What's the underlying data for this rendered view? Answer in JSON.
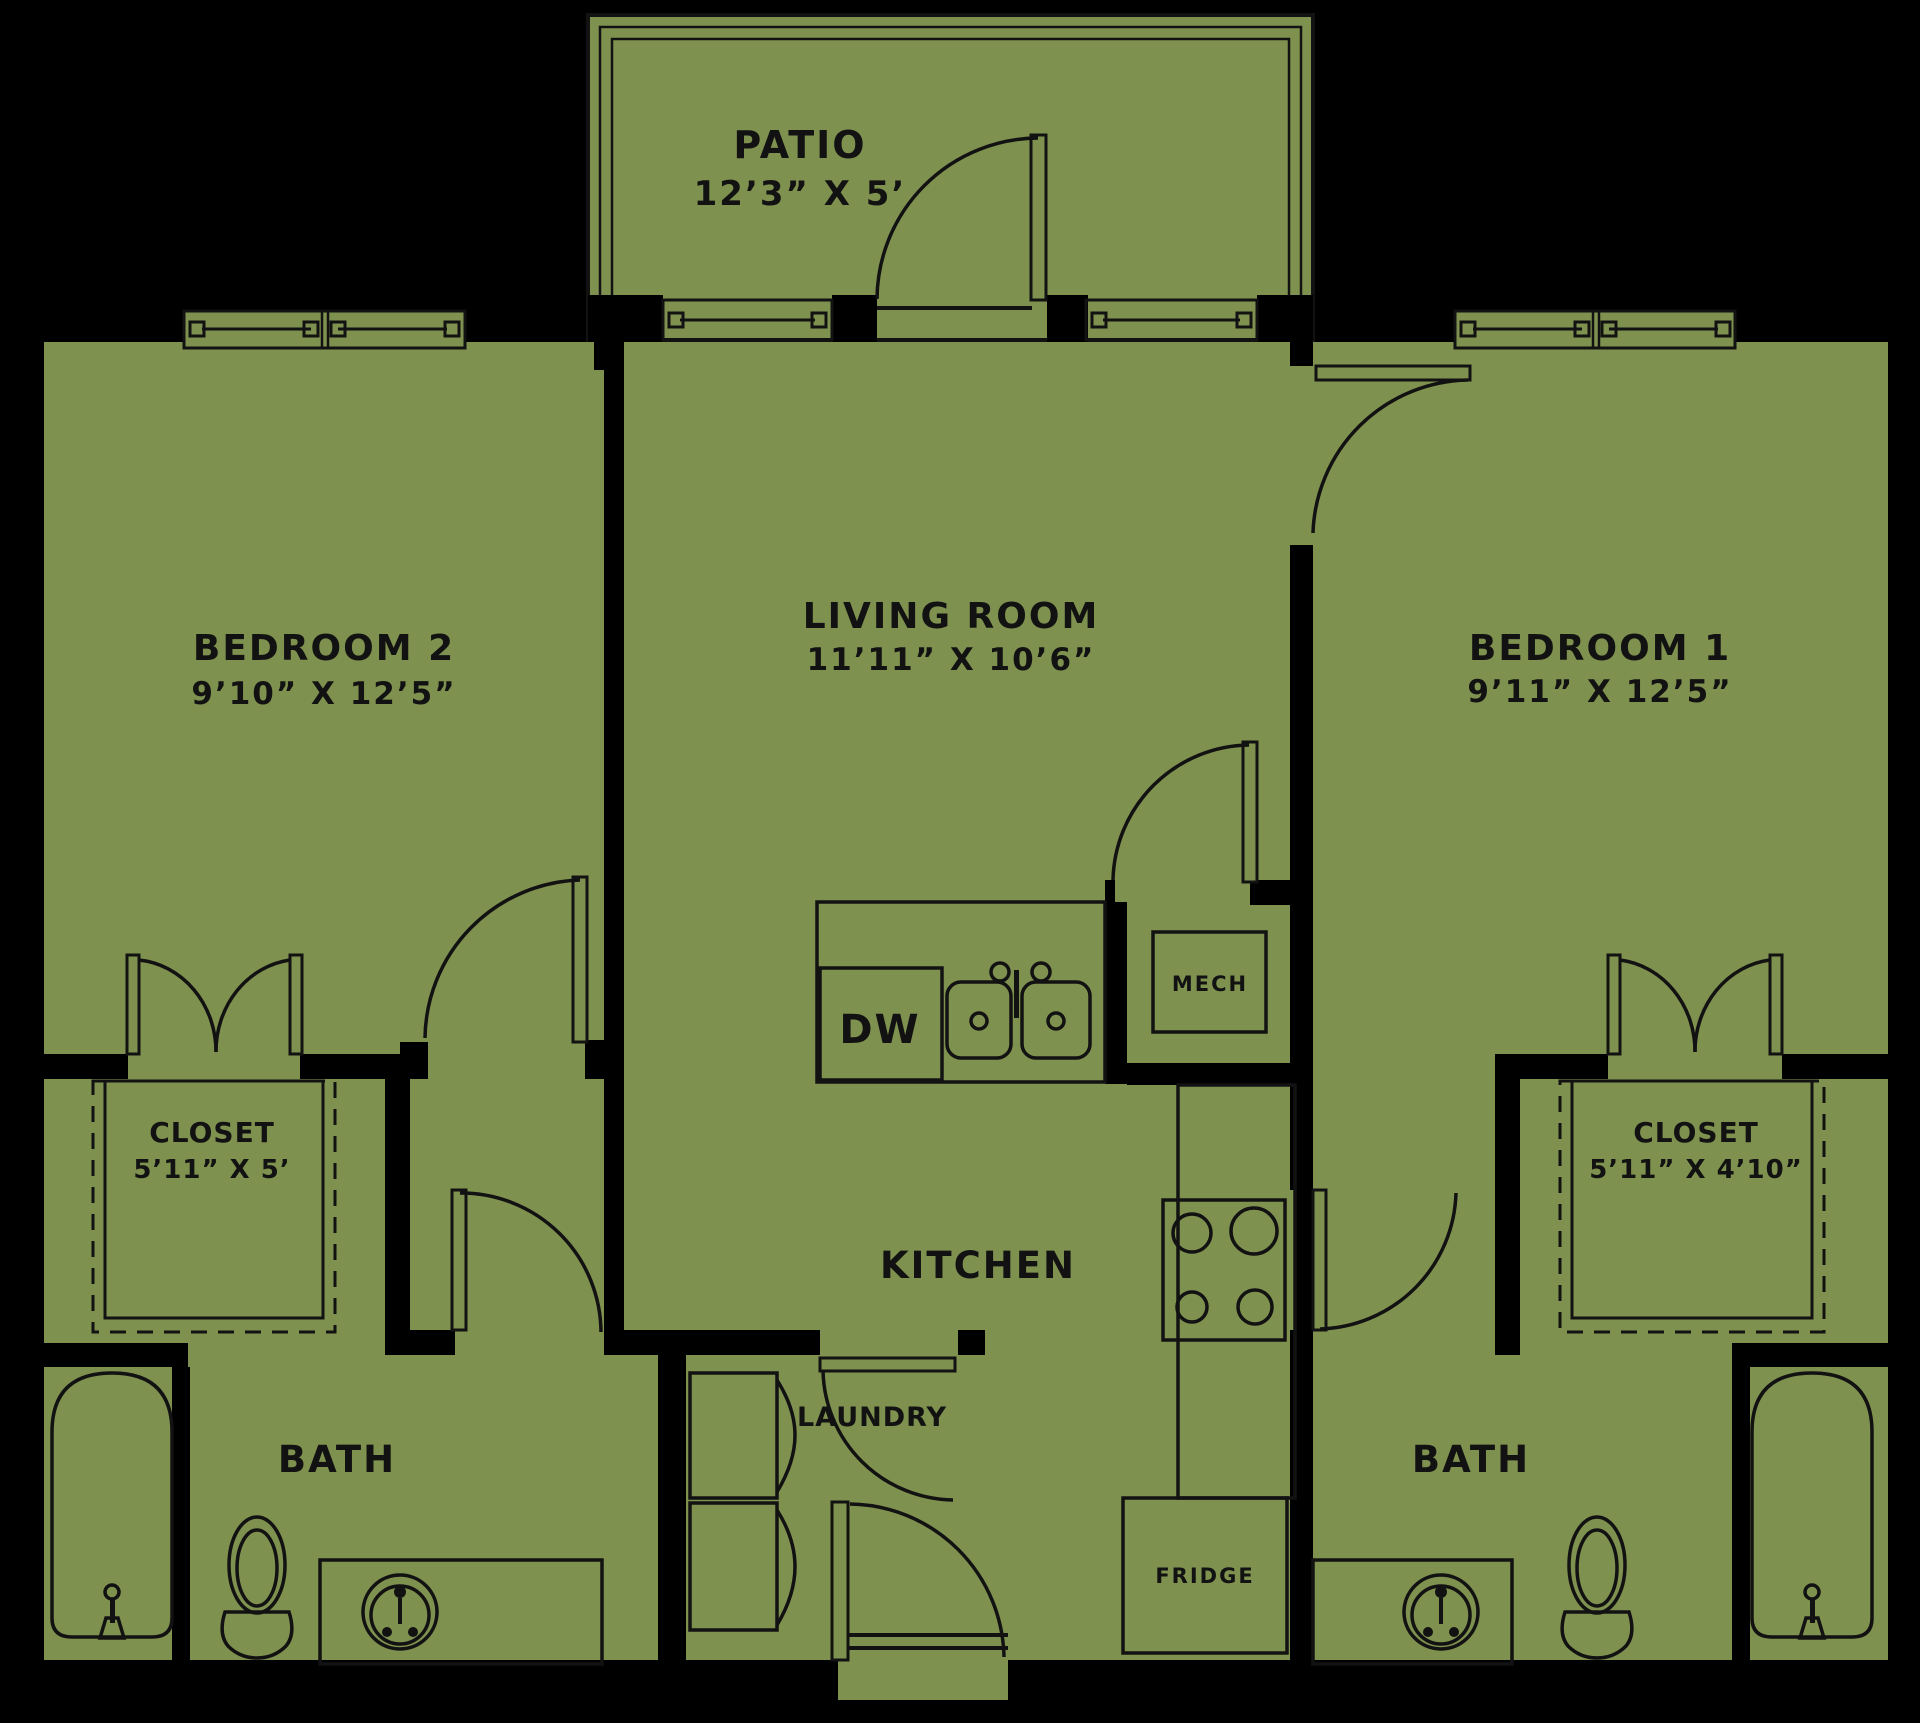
{
  "colors": {
    "background": "#000000",
    "floor": "#7f914f",
    "line": "#121212",
    "wall": "#000000"
  },
  "rooms": {
    "patio": {
      "name": "PATIO",
      "dims": "12’3” X 5’"
    },
    "bedroom2": {
      "name": "BEDROOM 2",
      "dims": "9’10” X 12’5”"
    },
    "living": {
      "name": "LIVING ROOM",
      "dims": "11’11” X 10’6”"
    },
    "bedroom1": {
      "name": "BEDROOM 1",
      "dims": "9’11” X 12’5”"
    },
    "closet2": {
      "name": "CLOSET",
      "dims": "5’11” X 5’"
    },
    "closet1": {
      "name": "CLOSET",
      "dims": "5’11” X 4’10”"
    },
    "kitchen": {
      "name": "KITCHEN"
    },
    "laundry": {
      "name": "LAUNDRY"
    },
    "bath2": {
      "name": "BATH"
    },
    "bath1": {
      "name": "BATH"
    },
    "mech": {
      "name": "MECH"
    },
    "dw": {
      "name": "DW"
    },
    "fridge": {
      "name": "FRIDGE"
    }
  }
}
